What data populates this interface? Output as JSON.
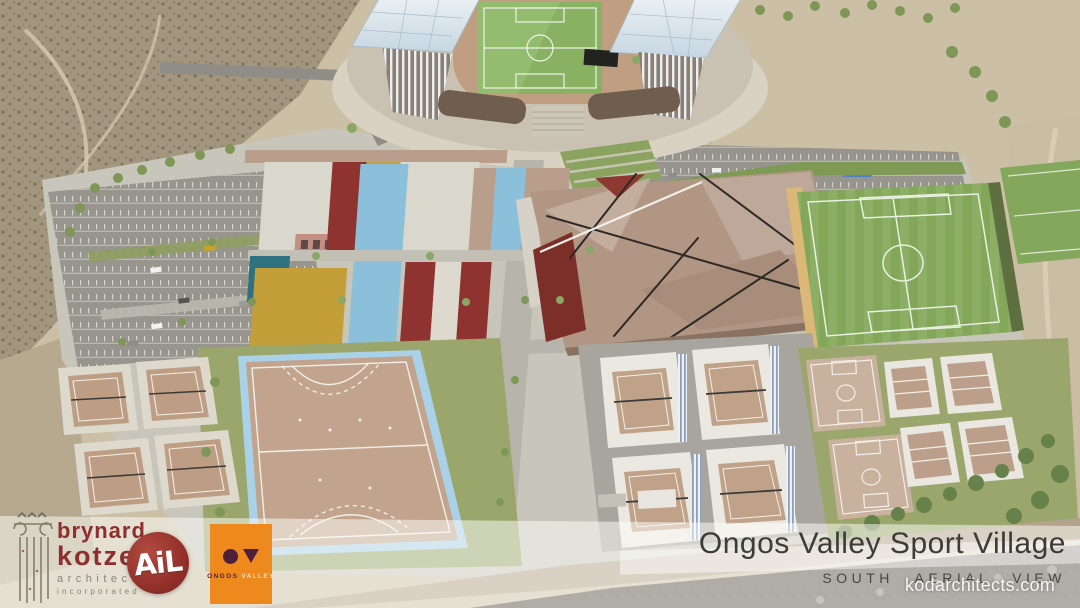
{
  "footer": {
    "architect_logo": {
      "line1": "brynard",
      "line2": "kotze",
      "line3": "architects",
      "line4": "incorporated"
    },
    "ail_logo": {
      "text": "AiL"
    },
    "ongos_logo": {
      "name_part1": "ONGOS",
      "name_part2": "VALLEY"
    },
    "title": "Ongos Valley Sport Village",
    "subtitle": "SOUTH AERIAL VIEW"
  },
  "watermark": "kodarchitects.com",
  "colors": {
    "architect_red": "#8e2f2f",
    "ail_red": "#8c2c26",
    "ongos_orange": "#ee8a1d",
    "ongos_plum": "#4e1f38",
    "title_text": "#3b3b39"
  }
}
